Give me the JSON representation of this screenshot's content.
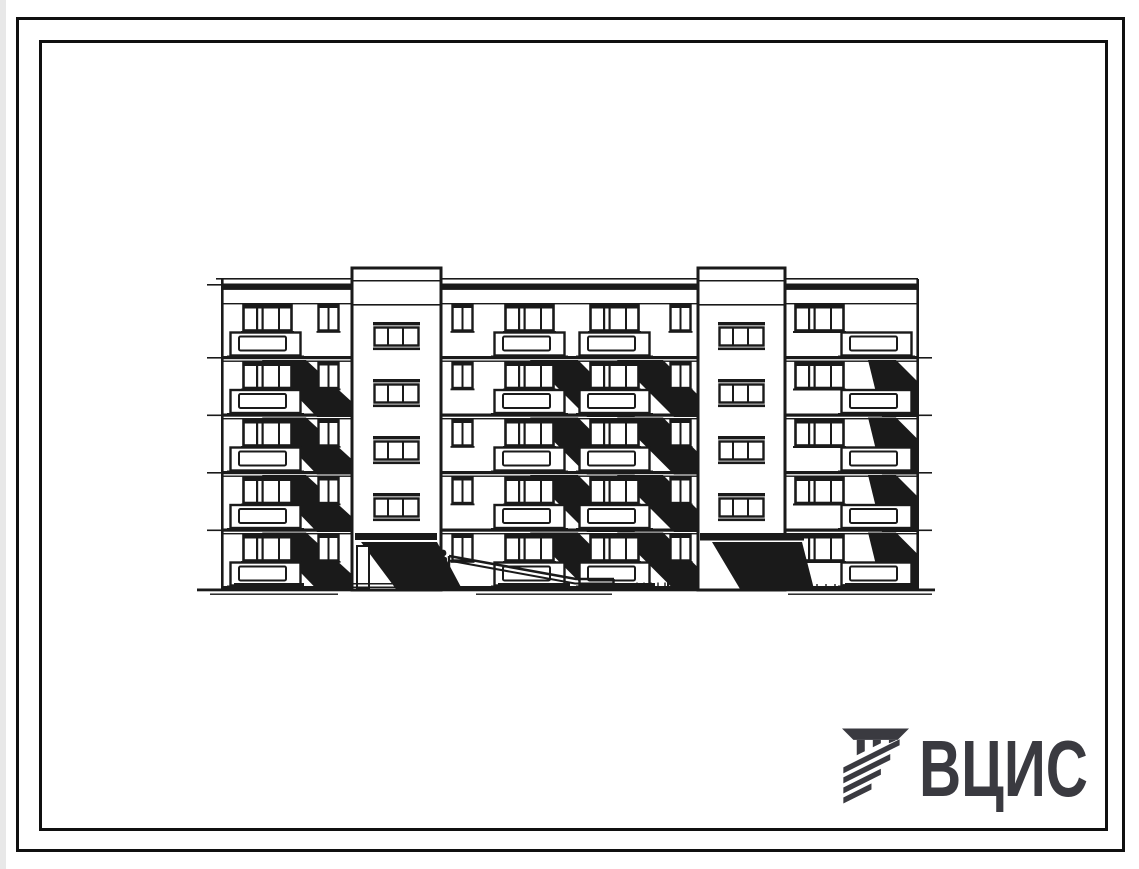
{
  "page": {
    "background": "#ffffff",
    "frame_color": "#101010",
    "ink_color": "#1a1a1a"
  },
  "logo": {
    "text": "ВЦИС",
    "color": "#3a3a40",
    "icon": "striped-monogram-icon"
  },
  "drawing": {
    "kind": "building-facade-elevation",
    "storeys": 5,
    "stair_towers": 2,
    "entrances": 2,
    "facade_sections": 3,
    "features": [
      "windows",
      "balconies-with-cast-shadows",
      "entrance-canopies",
      "ramp-handrail",
      "ground-line",
      "person-figure"
    ]
  }
}
